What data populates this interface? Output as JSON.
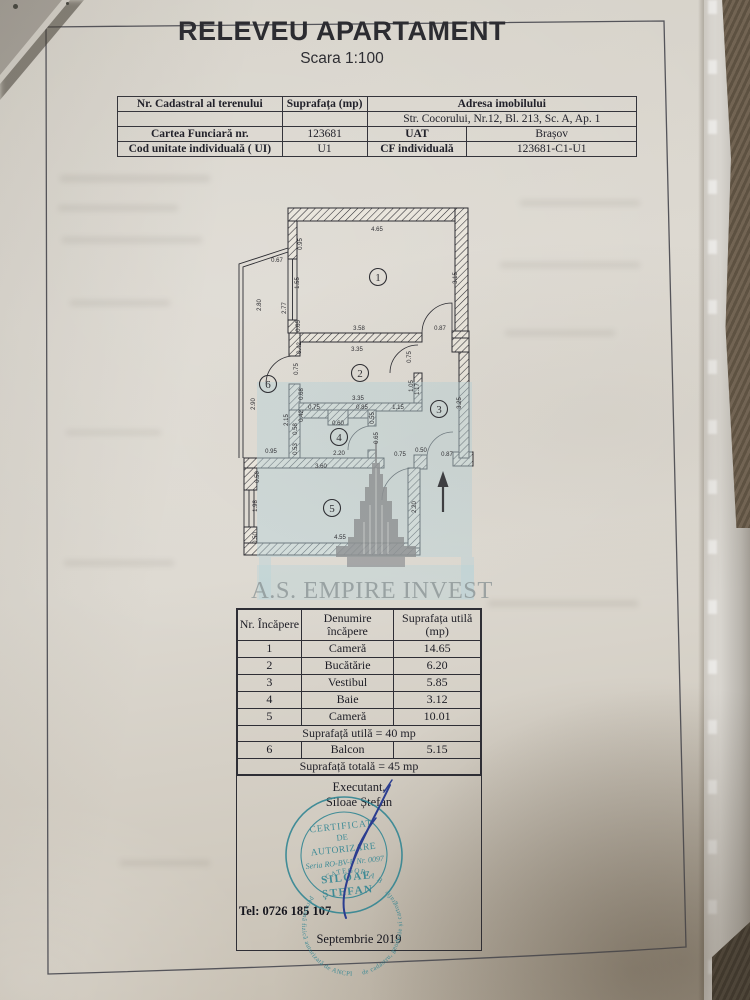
{
  "photo": {
    "paper_color": "#d9d5cc",
    "carpet_color": "#6a5c4a",
    "stamp_color": "#2e8492",
    "signature_color": "#2b3d90",
    "watermark_blue": "#b9d4da",
    "watermark_gray": "#8f9294"
  },
  "header": {
    "title": "RELEVEU APARTAMENT",
    "scale": "Scara 1:100"
  },
  "info_table": {
    "r1c1": "Nr. Cadastral al terenului",
    "r1c2": "Suprafața (mp)",
    "r1c3": "Adresa imobilului",
    "r2c3": "Str. Cocorului, Nr.12, Bl. 213, Sc. A, Ap. 1",
    "r3c1": "Cartea Funciară nr.",
    "r3c2": "123681",
    "r3c3": "UAT",
    "r3c4": "Brașov",
    "r4c1": "Cod unitate individuală ( UI)",
    "r4c2": "U1",
    "r4c3": "CF individuală",
    "r4c4": "123681-C1-U1"
  },
  "plan": {
    "rooms": [
      {
        "n": "1",
        "x": 378,
        "y": 277
      },
      {
        "n": "2",
        "x": 360,
        "y": 373
      },
      {
        "n": "3",
        "x": 439,
        "y": 409
      },
      {
        "n": "4",
        "x": 339,
        "y": 437
      },
      {
        "n": "5",
        "x": 332,
        "y": 508
      },
      {
        "n": "6",
        "x": 268,
        "y": 384
      }
    ],
    "dims": [
      {
        "t": "4.65",
        "x": 377,
        "y": 231,
        "v": 0
      },
      {
        "t": "0.67",
        "x": 277,
        "y": 262,
        "v": 0
      },
      {
        "t": "0.95",
        "x": 302,
        "y": 244,
        "v": 1
      },
      {
        "t": "1.55",
        "x": 299,
        "y": 283,
        "v": 1
      },
      {
        "t": "0.65",
        "x": 300,
        "y": 326,
        "v": 1
      },
      {
        "t": "2.80",
        "x": 261,
        "y": 305,
        "v": 1
      },
      {
        "t": "2.77",
        "x": 286,
        "y": 308,
        "v": 1
      },
      {
        "t": "3.15",
        "x": 457,
        "y": 278,
        "v": 1
      },
      {
        "t": "3.58",
        "x": 359,
        "y": 330,
        "v": 0
      },
      {
        "t": "3.35",
        "x": 357,
        "y": 351,
        "v": 0
      },
      {
        "t": "0.87",
        "x": 440,
        "y": 330,
        "v": 0
      },
      {
        "t": "0.42",
        "x": 301,
        "y": 348,
        "v": 1
      },
      {
        "t": "0.75",
        "x": 298,
        "y": 369,
        "v": 1
      },
      {
        "t": "0.75",
        "x": 411,
        "y": 357,
        "v": 1
      },
      {
        "t": "1.05",
        "x": 413,
        "y": 386,
        "v": 1
      },
      {
        "t": "1.17",
        "x": 419,
        "y": 389,
        "v": 1
      },
      {
        "t": "3.35",
        "x": 358,
        "y": 400,
        "v": 0
      },
      {
        "t": "0.68",
        "x": 303,
        "y": 394,
        "v": 1
      },
      {
        "t": "3.25",
        "x": 461,
        "y": 403,
        "v": 1
      },
      {
        "t": "2.90",
        "x": 255,
        "y": 404,
        "v": 1
      },
      {
        "t": "2.15",
        "x": 288,
        "y": 420,
        "v": 1
      },
      {
        "t": "0.75",
        "x": 314,
        "y": 409,
        "v": 0
      },
      {
        "t": "0.60",
        "x": 338,
        "y": 425,
        "v": 0
      },
      {
        "t": "0.85",
        "x": 362,
        "y": 409,
        "v": 0
      },
      {
        "t": "1.15",
        "x": 398,
        "y": 409,
        "v": 0
      },
      {
        "t": "0.42",
        "x": 303,
        "y": 416,
        "v": 1
      },
      {
        "t": "0.55",
        "x": 374,
        "y": 418,
        "v": 1
      },
      {
        "t": "0.65",
        "x": 378,
        "y": 438,
        "v": 1
      },
      {
        "t": "0.58",
        "x": 297,
        "y": 429,
        "v": 1
      },
      {
        "t": "0.53",
        "x": 297,
        "y": 449,
        "v": 1
      },
      {
        "t": "0.95",
        "x": 271,
        "y": 453,
        "v": 0
      },
      {
        "t": "2.20",
        "x": 339,
        "y": 455,
        "v": 0
      },
      {
        "t": "0.75",
        "x": 400,
        "y": 456,
        "v": 0
      },
      {
        "t": "0.50",
        "x": 421,
        "y": 452,
        "v": 0
      },
      {
        "t": "0.87",
        "x": 447,
        "y": 456,
        "v": 0
      },
      {
        "t": "3.60",
        "x": 321,
        "y": 468,
        "v": 0
      },
      {
        "t": "0.50",
        "x": 259,
        "y": 477,
        "v": 1
      },
      {
        "t": "1.98",
        "x": 257,
        "y": 506,
        "v": 1
      },
      {
        "t": "0.50",
        "x": 257,
        "y": 538,
        "v": 1
      },
      {
        "t": "2.20",
        "x": 416,
        "y": 507,
        "v": 1
      },
      {
        "t": "4.55",
        "x": 340,
        "y": 539,
        "v": 0
      }
    ]
  },
  "watermark": {
    "text": "A.S. EMPIRE INVEST"
  },
  "rooms_table": {
    "header_col1": "Nr. Încăpere",
    "header_col2_line1": "Denumire",
    "header_col2_line2": "încăpere",
    "header_col3_line1": "Suprafața utilă",
    "header_col3_line2": "(mp)",
    "rows": [
      [
        "1",
        "Cameră",
        "14.65"
      ],
      [
        "2",
        "Bucătărie",
        "6.20"
      ],
      [
        "3",
        "Vestibul",
        "5.85"
      ],
      [
        "4",
        "Baie",
        "3.12"
      ],
      [
        "5",
        "Cameră",
        "10.01"
      ]
    ],
    "subtotal": "Suprafață utilă = 40 mp",
    "balcony_row": [
      "6",
      "Balcon",
      "5.15"
    ],
    "total": "Suprafață totală = 45 mp"
  },
  "executant": {
    "label": "Executant,",
    "name": "Siloae Ștefan",
    "tel": "Tel: 0726 185 107",
    "date": "Septembrie 2019"
  },
  "stamp": {
    "line1": "CERTIFICAT",
    "line2": "DE",
    "line3": "AUTORIZARE",
    "line4": "Seria RO-BV-F Nr. 0097",
    "line5": "SILOAE",
    "line6": "ȘTEFAN",
    "bottom": "CATEGORIA B",
    "ring_left": "persoană fizică autorizată de ANCPI",
    "ring_right": "de cadastru, geodezie și cartografie"
  }
}
